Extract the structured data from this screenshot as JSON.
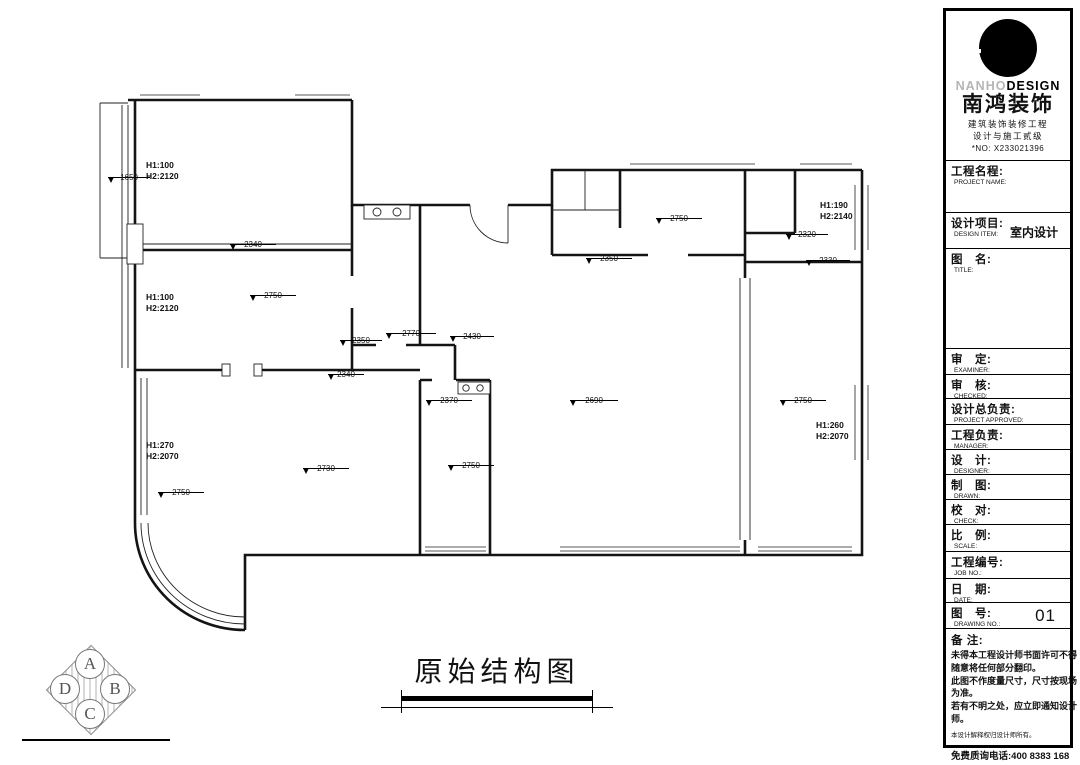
{
  "sheet": {
    "drawing_title": "原始结构图"
  },
  "logo": {
    "en_gray": "NANHO",
    "en_black": "DESIGN",
    "cn_name": "南鸿装饰",
    "cert1": "建筑装饰装修工程",
    "cert2": "设计与施工贰级",
    "cert_no": "*NO: X233021396"
  },
  "titleblock": {
    "rows": [
      {
        "cn": "工程名程:",
        "en": "PROJECT NAME:",
        "value": ""
      },
      {
        "cn": "设计项目:",
        "en": "DESIGN ITEM:",
        "value": "室内设计"
      },
      {
        "cn": "图　名:",
        "en": "TITLE:",
        "value": ""
      },
      {
        "cn": "审　定:",
        "en": "EXAMINER:",
        "value": ""
      },
      {
        "cn": "审　核:",
        "en": "CHECKED:",
        "value": ""
      },
      {
        "cn": "设计总负责:",
        "en": "PROJECT APPROVED:",
        "value": ""
      },
      {
        "cn": "工程负责:",
        "en": "MANAGER:",
        "value": ""
      },
      {
        "cn": "设　计:",
        "en": "DESIGNER:",
        "value": ""
      },
      {
        "cn": "制　图:",
        "en": "DRAWN:",
        "value": ""
      },
      {
        "cn": "校　对:",
        "en": "CHECK:",
        "value": ""
      },
      {
        "cn": "比　例:",
        "en": "SCALE:",
        "value": ""
      },
      {
        "cn": "工程编号:",
        "en": "JOB NO.:",
        "value": ""
      },
      {
        "cn": "日　期:",
        "en": "DATE:",
        "value": ""
      },
      {
        "cn": "图　号:",
        "en": "DRAWING NO.:",
        "value": "01"
      }
    ],
    "notes": {
      "label": "备 注:",
      "lines": [
        "未得本工程设计师书面许可不得",
        "随意将任何部分翻印。",
        "此图不作度量尺寸，尺寸按现场",
        "为准。",
        "若有不明之处，应立即通知设计",
        "师。"
      ],
      "fine_print": "本设计解释权归设计师所有。",
      "phone": "免费质询电话:400 8383 168"
    }
  },
  "plan": {
    "elevations": [
      {
        "value": "1650"
      },
      {
        "value": "2340"
      },
      {
        "value": "2750"
      },
      {
        "value": "2350"
      },
      {
        "value": "2770"
      },
      {
        "value": "2430"
      },
      {
        "value": "2340"
      },
      {
        "value": "2370"
      },
      {
        "value": "2690"
      },
      {
        "value": "2750"
      },
      {
        "value": "2750"
      },
      {
        "value": "2350"
      },
      {
        "value": "2320"
      },
      {
        "value": "2330"
      },
      {
        "value": "2750"
      },
      {
        "value": "2730"
      },
      {
        "value": "2750"
      }
    ],
    "window_labels": [
      {
        "line1": "H1:100",
        "line2": "H2:2120"
      },
      {
        "line1": "H1:100",
        "line2": "H2:2120"
      },
      {
        "line1": "H1:270",
        "line2": "H2:2070"
      },
      {
        "line1": "H1:190",
        "line2": "H2:2140"
      },
      {
        "line1": "H1:260",
        "line2": "H2:2070"
      }
    ]
  },
  "corner_logo": {
    "top": "A",
    "left": "D",
    "right": "B",
    "bottom": "C"
  }
}
